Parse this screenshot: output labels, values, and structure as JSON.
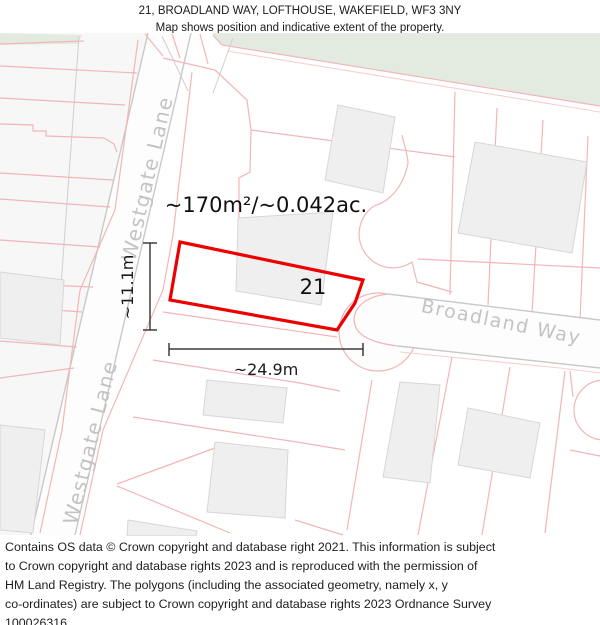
{
  "title": {
    "line1": "21, BROADLAND WAY, LOFTHOUSE, WAKEFIELD, WF3 3NY",
    "line2": "Map shows position and indicative extent of the property."
  },
  "map": {
    "plot_number": "21",
    "area_label": "~170m²/~0.042ac.",
    "width_label": "~24.9m",
    "depth_label": "~11.1m",
    "street_labels": {
      "westgate_upper": "Westgate Lane",
      "westgate_lower": "Westgate Lane",
      "broadland": "Broadland Way"
    },
    "colors": {
      "property_outline": "#ed0000",
      "parcel_line": "#f2b6b6",
      "road_edge": "#c9c9c9",
      "green_space": "#e3ebe0",
      "building_fill": "#f0efef",
      "street_label_text": "#c3c3c3"
    }
  },
  "footer": {
    "lines": [
      "Contains OS data © Crown copyright and database right 2021. This information is subject",
      "to Crown copyright and database rights 2023 and is reproduced with the permission of",
      "HM Land Registry. The polygons (including the associated geometry, namely x, y",
      "co-ordinates) are subject to Crown copyright and database rights 2023 Ordnance Survey",
      "100026316."
    ]
  }
}
